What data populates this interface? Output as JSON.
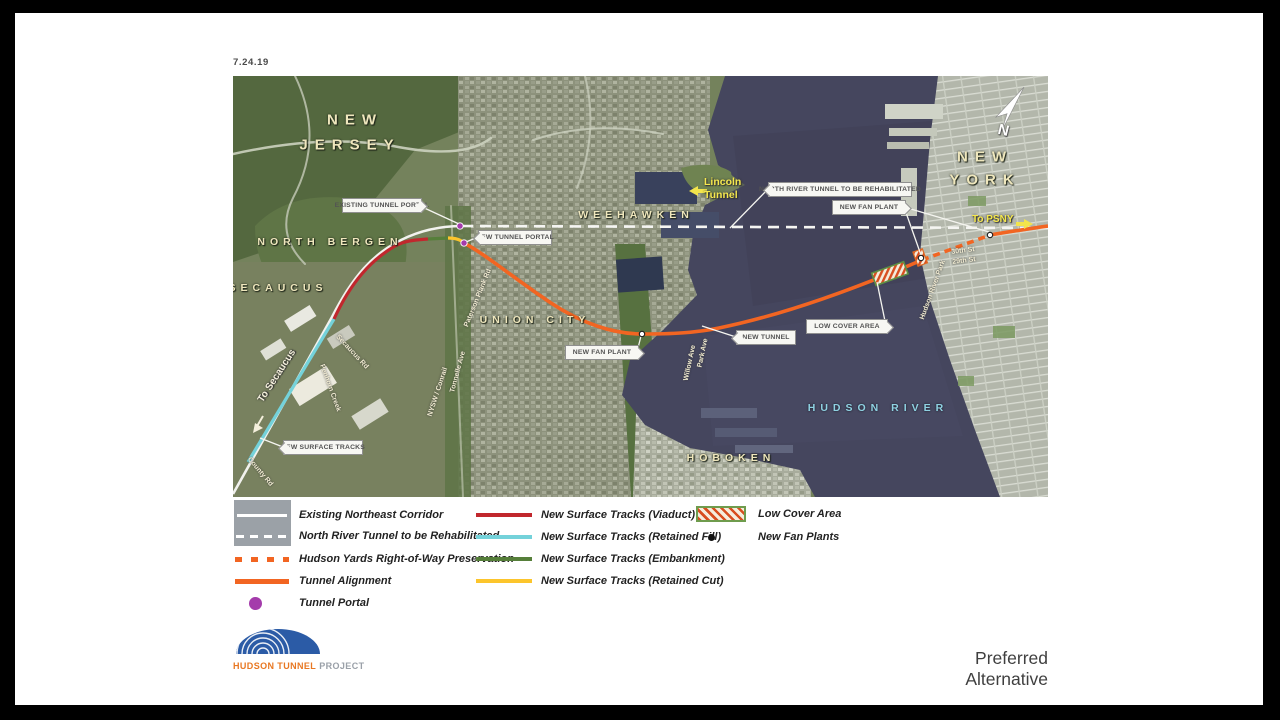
{
  "date": "7.24.19",
  "title": "Preferred Alternative",
  "logo": {
    "name": "HUDSON TUNNEL",
    "suffix": "PROJECT"
  },
  "compass": {
    "label": "N"
  },
  "map": {
    "regions": {
      "new_jersey_1": "NEW",
      "new_jersey_2": "JERSEY",
      "new_york_1": "NEW",
      "new_york_2": "YORK",
      "north_bergen": "NORTH BERGEN",
      "secaucus": "SECAUCUS",
      "weehawken": "WEEHAWKEN",
      "union_city": "UNION CITY",
      "hoboken": "HOBOKEN",
      "hudson_river": "HUDSON RIVER"
    },
    "pois": {
      "lincoln_tunnel_1": "Lincoln",
      "lincoln_tunnel_2": "Tunnel",
      "to_psny": "To PSNY",
      "to_secaucus": "To Secaucus"
    },
    "streets": {
      "secaucus_rd": "Secaucus Rd",
      "penhorn_creek": "Penhorn Creek",
      "nysw_conrail": "NYSW / Conrail",
      "tonnelle_ave": "Tonnelle Ave",
      "paterson_plank_rd": "Paterson Plank Rd",
      "county_rd": "County Rd",
      "park_ave": "Park Ave",
      "willow_ave": "Willow Ave",
      "hudson_river_park": "Hudson River Park",
      "st30": "30th St",
      "st29": "29th St"
    },
    "callouts": {
      "existing_tunnel_portal": "EXISTING TUNNEL PORTAL",
      "new_tunnel_portal": "NEW TUNNEL PORTAL",
      "north_river_tunnel": "NORTH RIVER TUNNEL TO BE REHABILITATED",
      "new_fan_plant_ny": "NEW FAN PLANT",
      "new_fan_plant_nj": "NEW FAN PLANT",
      "new_tunnel": "NEW TUNNEL",
      "low_cover_area": "LOW COVER AREA",
      "new_surface_tracks": "NEW SURFACE TRACKS"
    }
  },
  "legend": {
    "items": [
      {
        "label": "Existing Northeast Corridor",
        "swatch": "white-line-on-road"
      },
      {
        "label": "North River Tunnel to be Rehabilitated",
        "swatch": "white-dashed-on-road"
      },
      {
        "label": "Hudson Yards Right-of-Way Preservation",
        "swatch": "orange-dashed"
      },
      {
        "label": "Tunnel Alignment",
        "swatch": "orange-solid"
      },
      {
        "label": "Tunnel Portal",
        "swatch": "purple-dot"
      },
      {
        "label": "New Surface Tracks (Viaduct)",
        "swatch": "red-line"
      },
      {
        "label": "New Surface Tracks (Retained Fill)",
        "swatch": "cyan-line"
      },
      {
        "label": "New Surface Tracks (Embankment)",
        "swatch": "green-line"
      },
      {
        "label": "New Surface Tracks (Retained Cut)",
        "swatch": "yellow-line"
      },
      {
        "label": "Low Cover Area",
        "swatch": "hatched-area"
      },
      {
        "label": "New Fan Plants",
        "swatch": "black-dot"
      }
    ]
  },
  "colors": {
    "tunnel_orange": "#F26522",
    "viaduct_red": "#C1272D",
    "retained_fill_cyan": "#74D2DA",
    "embankment_green": "#567F3A",
    "retained_cut_yellow": "#FCC52C",
    "portal_purple": "#A43BAB",
    "water": "#45465E",
    "map_label_cream": "#EFE7BD",
    "river_label_cyan": "#8FD2E2",
    "logo_blue": "#2B5BA6",
    "logo_orange": "#E87722"
  }
}
